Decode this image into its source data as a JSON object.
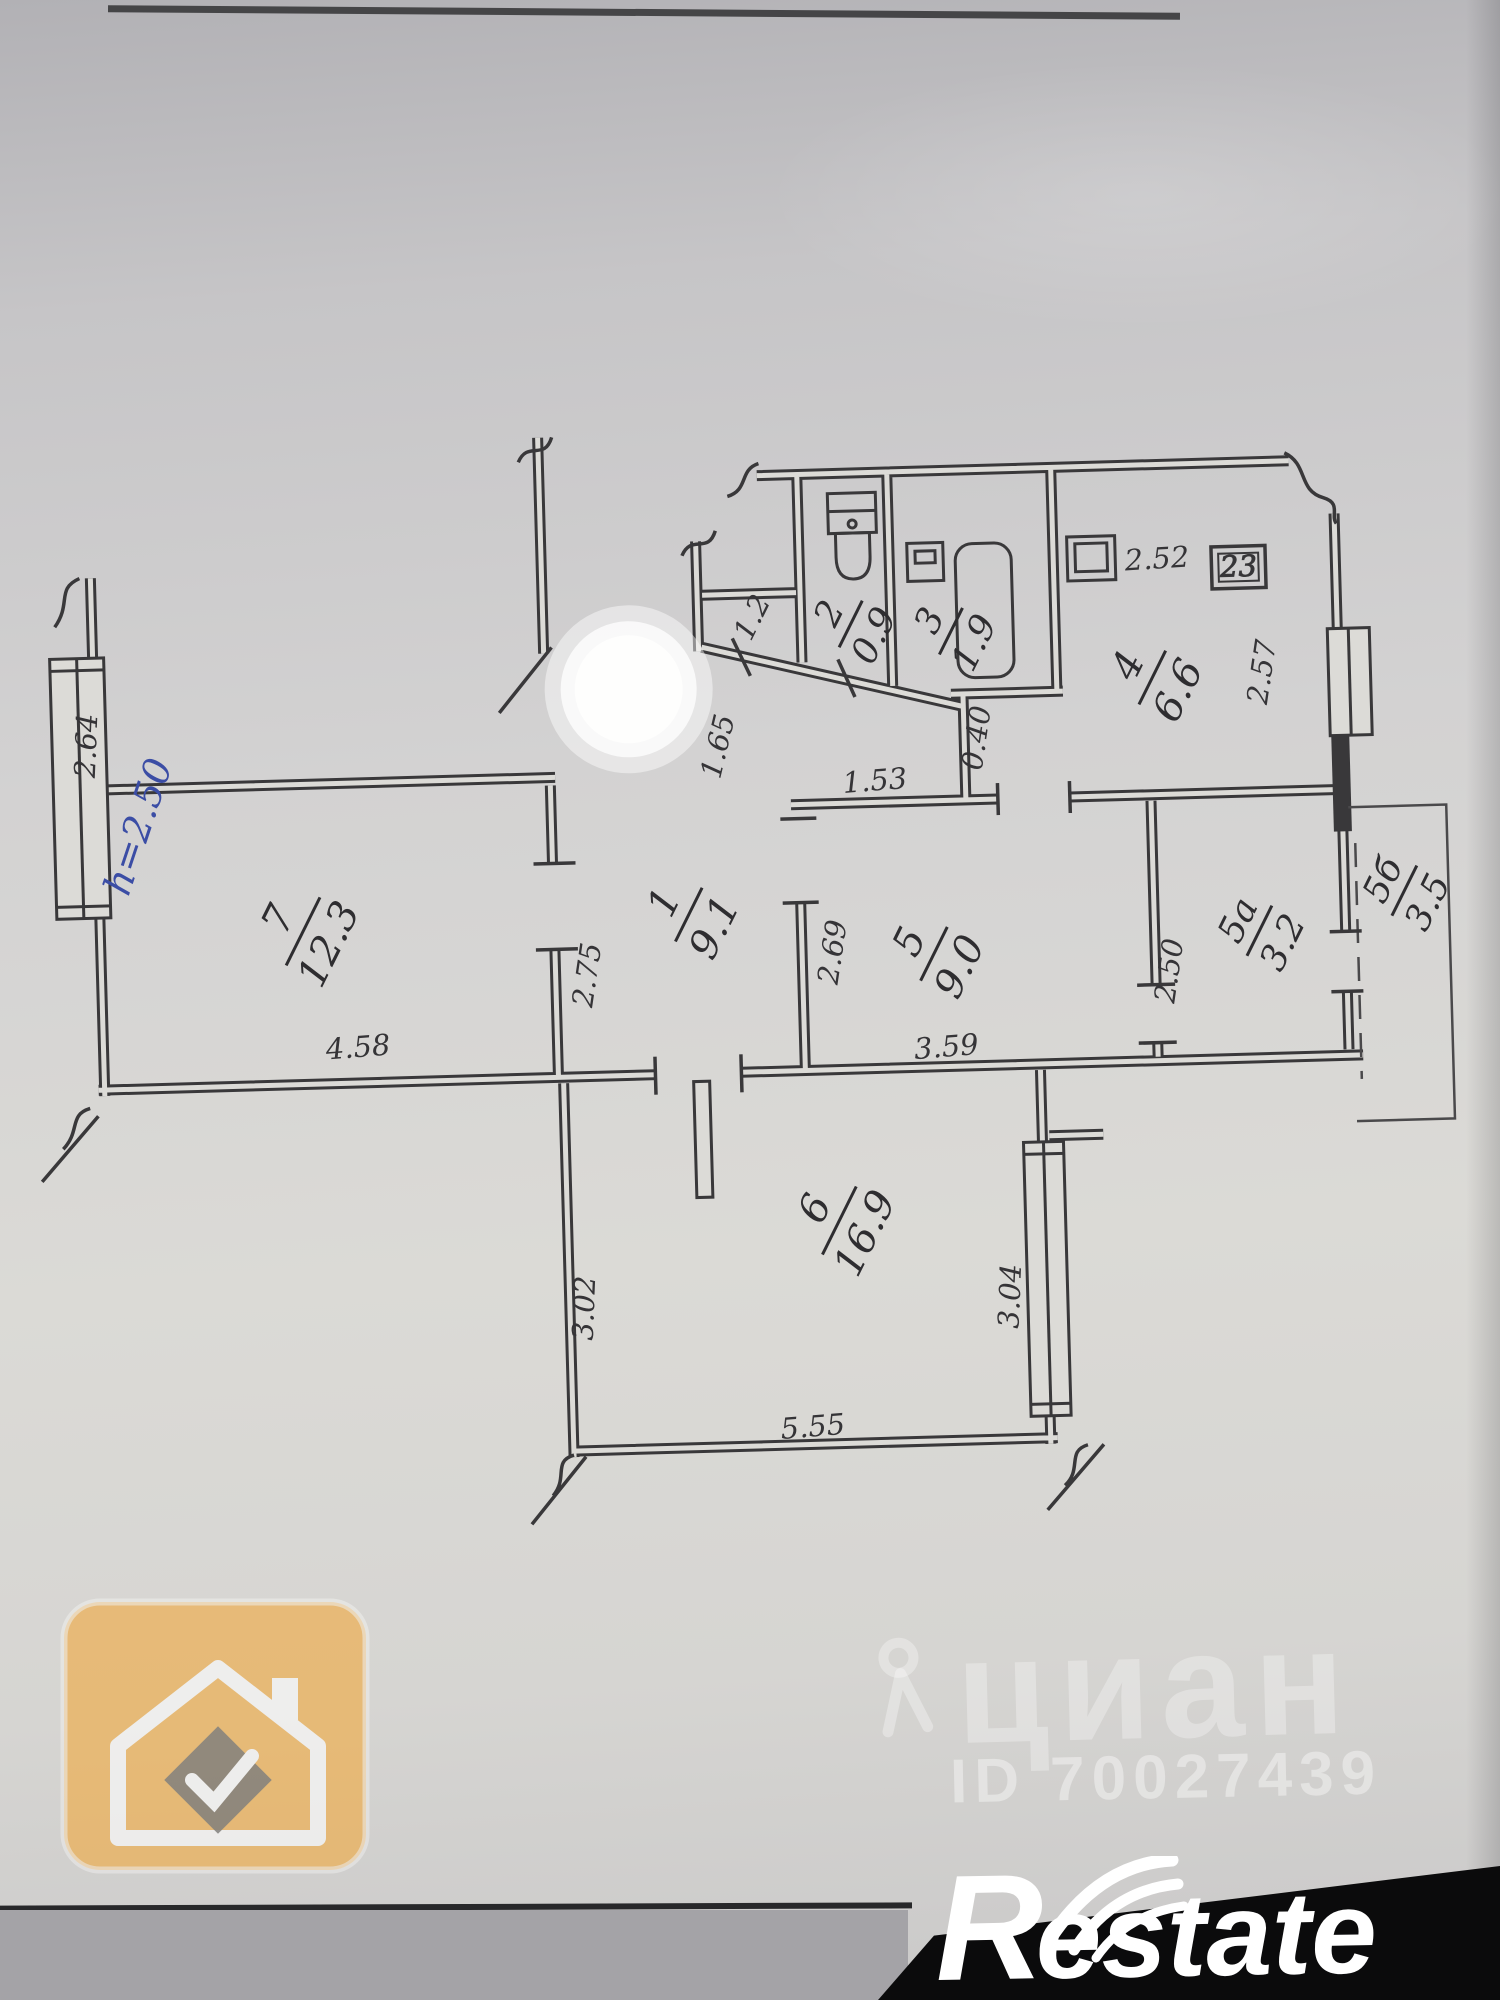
{
  "floor_plan": {
    "rooms": [
      {
        "num": "1",
        "area": "9.1"
      },
      {
        "num": "2",
        "area": "0.9"
      },
      {
        "num": "3",
        "area": "1.9"
      },
      {
        "num": "4",
        "area": "6.6"
      },
      {
        "num": "5",
        "area": "9.0"
      },
      {
        "num": "5а",
        "area": "3.2"
      },
      {
        "num": "5б",
        "area": "3.5"
      },
      {
        "num": "6",
        "area": "16.9"
      },
      {
        "num": "7",
        "area": "12.3"
      }
    ],
    "dims": {
      "entry": "1.2",
      "hall": "1.65",
      "kitchen_top": "2.52",
      "kitchen_right": "2.57",
      "room5_top": "1.53",
      "niche": "0.40",
      "room5_left": "2.69",
      "room7_right": "2.75",
      "room7_left": "2.64",
      "room7_bottom": "4.58",
      "room5_bottom": "3.59",
      "closet_left": "2.50",
      "room6_left": "3.02",
      "room6_right": "3.04",
      "room6_bottom": "5.55"
    },
    "notes": {
      "ceiling_height": "h=2.50",
      "unit_box": "23"
    }
  },
  "watermarks": {
    "cian_name": "циан",
    "cian_id": "ID 70027439",
    "restate_r": "R",
    "restate_rest": "estate"
  }
}
